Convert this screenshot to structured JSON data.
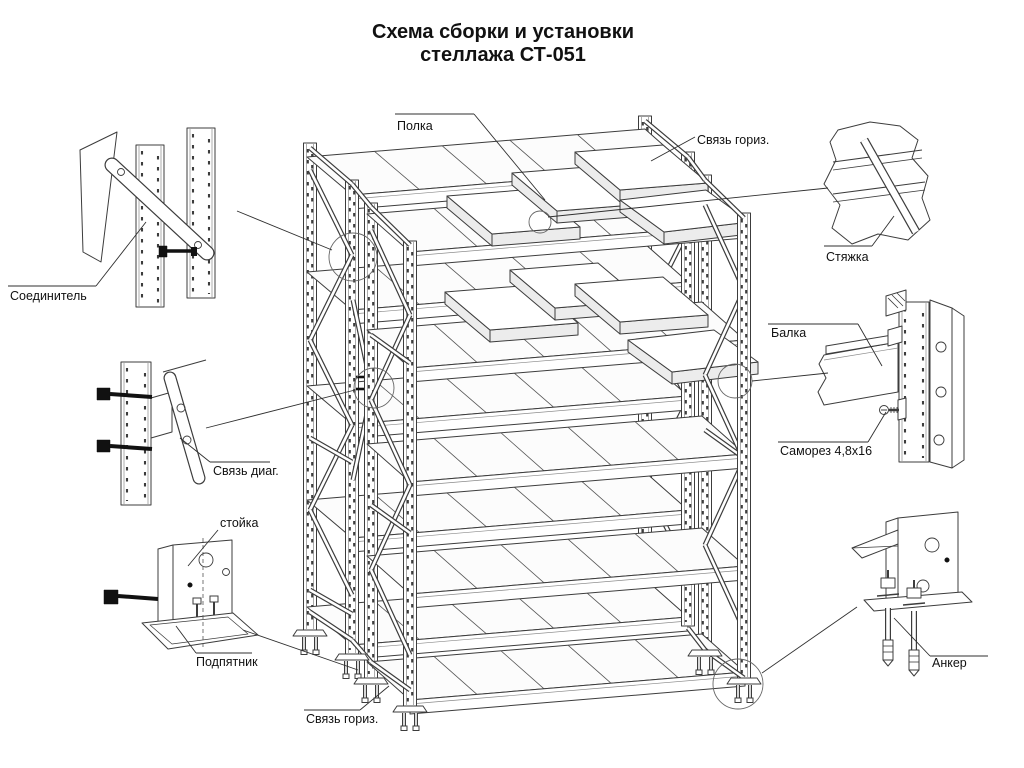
{
  "title": {
    "line1": "Схема сборки и установки",
    "line2": "стеллажа СТ-051"
  },
  "callouts": {
    "polka": "Полка",
    "svyaz_goriz_top": "Связь гориз.",
    "styazhka": "Стяжка",
    "soedinitel": "Соединитель",
    "balka": "Балка",
    "samorez": "Саморез 4,8х16",
    "svyaz_diag": "Связь диаг.",
    "stoyka": "стойка",
    "podpyatnik": "Подпятник",
    "anker": "Анкер",
    "svyaz_goriz_bottom": "Связь гориз."
  },
  "colors": {
    "line": "#3c3c3c",
    "leader": "#2f2f2f",
    "text": "#111111",
    "background": "#ffffff",
    "shelf_fill": "#fcfcfc",
    "slab_side": "#ececec"
  }
}
